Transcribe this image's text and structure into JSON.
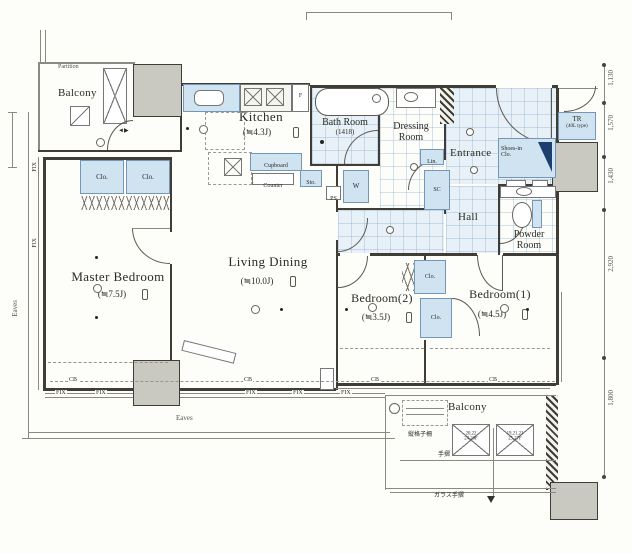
{
  "rooms": {
    "balcony_top": {
      "label": "Balcony"
    },
    "kitchen": {
      "label": "Kitchen",
      "size": "(≒4.3J)"
    },
    "bath": {
      "label": "Bath Room",
      "size": "(1418)"
    },
    "dressing": {
      "label": "Dressing Room"
    },
    "entrance": {
      "label": "Entrance"
    },
    "hall": {
      "label": "Hall"
    },
    "powder": {
      "label": "Powder Room"
    },
    "master": {
      "label": "Master Bedroom",
      "size": "(≒7.5J)"
    },
    "living": {
      "label": "Living Dining",
      "size": "(≒10.0J)"
    },
    "bedroom2": {
      "label": "Bedroom(2)",
      "size": "(≒3.5J)"
    },
    "bedroom1": {
      "label": "Bedroom(1)",
      "size": "(≒4.5J)"
    },
    "balcony_bottom": {
      "label": "Balcony"
    }
  },
  "fixtures": {
    "clo": "Clo.",
    "lin": "Lin.",
    "sc": "SC",
    "shoes_clo": "Shoes-in Clo.",
    "sh": "Sh.",
    "sto": "Sto.",
    "washer": "W",
    "ps": "PS",
    "fridge": "F",
    "tr": "TR",
    "tr_type": "(40L type)",
    "cupboard": "Cupboard",
    "counter": "Counter"
  },
  "annotations": {
    "partition": "Partition",
    "eaves": "Eaves",
    "fix": "FIX",
    "cb": "CB",
    "handrail": "手摺",
    "glass_handrail": "ガラス手摺",
    "lattice": "縦格子柵",
    "hatch_left_line1": "20,22",
    "hatch_left_line2": "24,26F",
    "hatch_right_line1": "19,21,23",
    "hatch_right_line2": "25,27F"
  },
  "dimensions": {
    "right": [
      "1,130",
      "1,570",
      "1,430",
      "2,920",
      "1,800"
    ]
  }
}
